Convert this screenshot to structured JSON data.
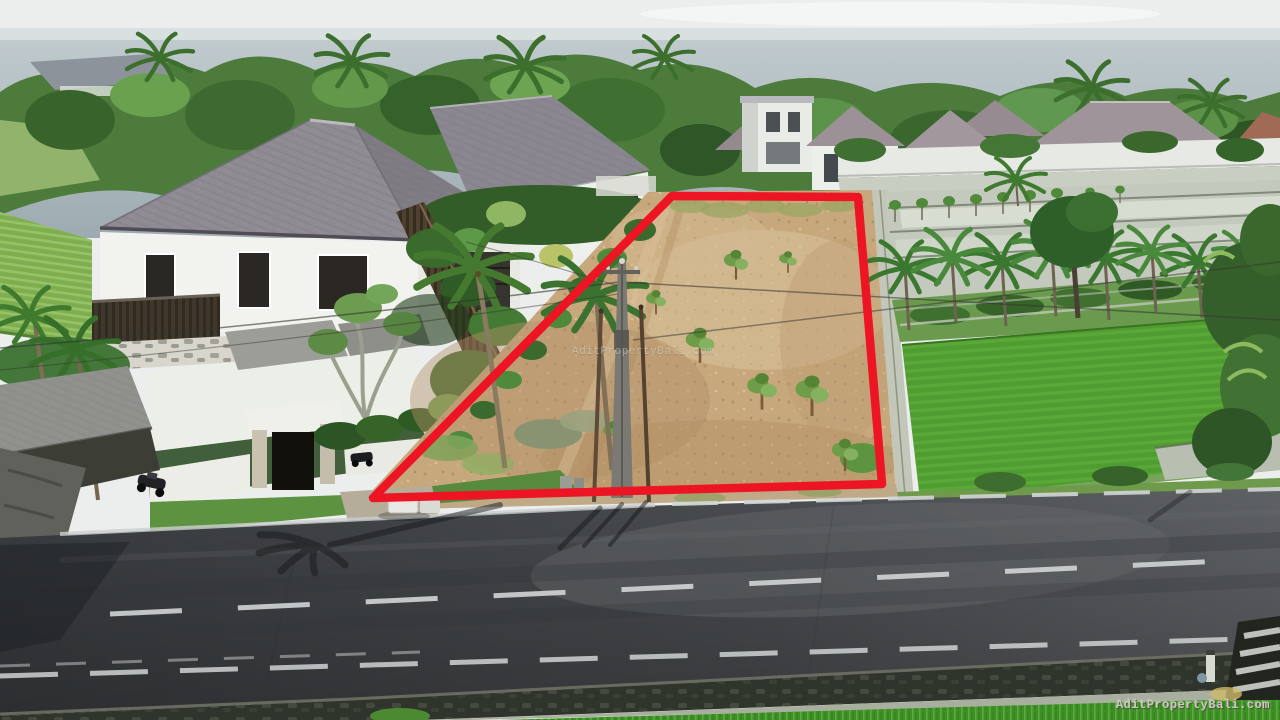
{
  "image": {
    "kind": "aerial-drone-photograph",
    "subject": "Vacant land plot outlined in red next to a road, flanked by white villas with gray hip roofs, palm trees, green rice paddies and the ocean on the horizon"
  },
  "watermarks": {
    "center": "AditPropertyBali.com",
    "bottom_right": "AditPropertyBali.com"
  },
  "colors": {
    "plot_outline_red": "#ed1423",
    "dirt_tan": "#c7a87c",
    "ocean_blue_gray": "#a9b6bb",
    "sky_white": "#eceeed",
    "asphalt_gray": "#46494c",
    "rice_paddy_green": "#4f9c31",
    "villa_roof_gray": "#8f8b92",
    "villa_wall_white": "#f2f2ee",
    "road_marking_white": "#d2d5d6"
  }
}
